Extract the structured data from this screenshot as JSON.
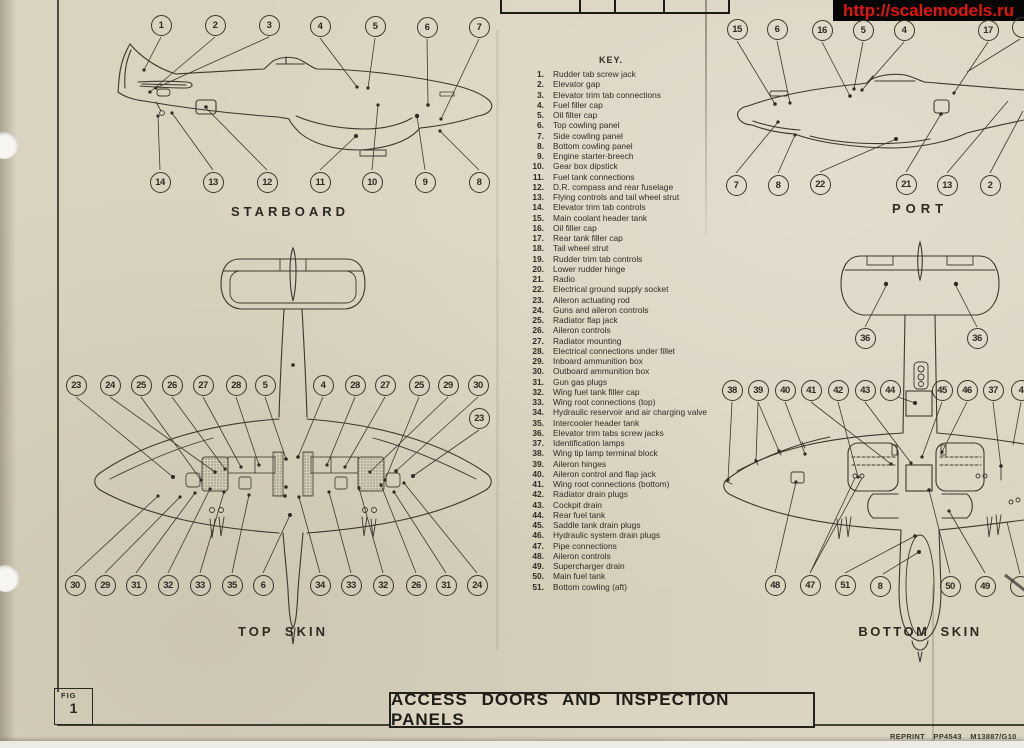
{
  "banner": {
    "url_text": "http://scalemodels.ru",
    "bg_color": "#060606",
    "text_color": "#e41410"
  },
  "header_table": {
    "cells": [
      "",
      "",
      "SECT.",
      "CHAP."
    ]
  },
  "view_labels": {
    "starboard": "STARBOARD",
    "port": "PORT",
    "topskin": "TOP SKIN",
    "bottomskin": "BOTTOM SKIN"
  },
  "key": {
    "title": "KEY.",
    "items": [
      {
        "n": "1.",
        "t": "Rudder tab screw jack"
      },
      {
        "n": "2.",
        "t": "Elevator gap"
      },
      {
        "n": "3.",
        "t": "Elevator trim tab connections"
      },
      {
        "n": "4.",
        "t": "Fuel filler cap"
      },
      {
        "n": "5.",
        "t": "Oil filter cap"
      },
      {
        "n": "6.",
        "t": "Top cowling panel"
      },
      {
        "n": "7.",
        "t": "Side cowling panel"
      },
      {
        "n": "8.",
        "t": "Bottom cowling panel"
      },
      {
        "n": "9.",
        "t": "Engine starter-breech"
      },
      {
        "n": "10.",
        "t": "Gear box dipstick"
      },
      {
        "n": "11.",
        "t": "Fuel tank connections"
      },
      {
        "n": "12.",
        "t": "D.R. compass and rear fuselage"
      },
      {
        "n": "13.",
        "t": "Flying controls and tail wheel strut"
      },
      {
        "n": "14.",
        "t": "Elevator trim tab controls"
      },
      {
        "n": "15.",
        "t": "Main coolant header tank"
      },
      {
        "n": "16.",
        "t": "Oil filler cap"
      },
      {
        "n": "17.",
        "t": "Rear tank filler cap"
      },
      {
        "n": "18.",
        "t": "Tail wheel strut"
      },
      {
        "n": "19.",
        "t": "Rudder trim tab controls"
      },
      {
        "n": "20.",
        "t": "Lower rudder hinge"
      },
      {
        "n": "21.",
        "t": "Radio"
      },
      {
        "n": "22.",
        "t": "Electrical ground supply socket"
      },
      {
        "n": "23.",
        "t": "Aileron actuating rod"
      },
      {
        "n": "24.",
        "t": "Guns and aileron controls"
      },
      {
        "n": "25.",
        "t": "Radiator flap jack"
      },
      {
        "n": "26.",
        "t": "Aileron controls"
      },
      {
        "n": "27.",
        "t": "Radiator mounting"
      },
      {
        "n": "28.",
        "t": "Electrical connections under fillet"
      },
      {
        "n": "29.",
        "t": "Inboard ammunition box"
      },
      {
        "n": "30.",
        "t": "Outboard ammunition box"
      },
      {
        "n": "31.",
        "t": "Gun gas plugs"
      },
      {
        "n": "32.",
        "t": "Wing fuel tank filler cap"
      },
      {
        "n": "33.",
        "t": "Wing root connections (top)"
      },
      {
        "n": "34.",
        "t": "Hydraulic reservoir and air charging valve"
      },
      {
        "n": "35.",
        "t": "Intercooler header tank"
      },
      {
        "n": "36.",
        "t": "Elevator trim tabs screw jacks"
      },
      {
        "n": "37.",
        "t": "Identification lamps"
      },
      {
        "n": "38.",
        "t": "Wing tip lamp terminal block"
      },
      {
        "n": "39.",
        "t": "Aileron hinges"
      },
      {
        "n": "40.",
        "t": "Aileron control and flap jack"
      },
      {
        "n": "41.",
        "t": "Wing root connections (bottom)"
      },
      {
        "n": "42.",
        "t": "Radiator drain plugs"
      },
      {
        "n": "43.",
        "t": "Cockpit drain"
      },
      {
        "n": "44.",
        "t": "Rear fuel tank"
      },
      {
        "n": "45.",
        "t": "Saddle tank drain plugs"
      },
      {
        "n": "46.",
        "t": "Hydraulic system drain plugs"
      },
      {
        "n": "47.",
        "t": "Pipe connections"
      },
      {
        "n": "48.",
        "t": "Aileron controls"
      },
      {
        "n": "49.",
        "t": "Supercharger drain"
      },
      {
        "n": "50.",
        "t": "Main fuel tank"
      },
      {
        "n": "51.",
        "t": "Bottom cowling (aft)"
      }
    ]
  },
  "callouts": [
    {
      "n": "1",
      "x": 161,
      "y": 25
    },
    {
      "n": "2",
      "x": 215,
      "y": 25
    },
    {
      "n": "3",
      "x": 269,
      "y": 25
    },
    {
      "n": "4",
      "x": 320,
      "y": 26
    },
    {
      "n": "5",
      "x": 375,
      "y": 26
    },
    {
      "n": "6",
      "x": 427,
      "y": 27
    },
    {
      "n": "7",
      "x": 479,
      "y": 27
    },
    {
      "n": "14",
      "x": 160,
      "y": 182
    },
    {
      "n": "13",
      "x": 213,
      "y": 182
    },
    {
      "n": "12",
      "x": 267,
      "y": 182
    },
    {
      "n": "11",
      "x": 320,
      "y": 182
    },
    {
      "n": "10",
      "x": 372,
      "y": 182
    },
    {
      "n": "9",
      "x": 425,
      "y": 182
    },
    {
      "n": "8",
      "x": 479,
      "y": 182
    },
    {
      "n": "15",
      "x": 737,
      "y": 29
    },
    {
      "n": "6",
      "x": 777,
      "y": 29
    },
    {
      "n": "16",
      "x": 822,
      "y": 30
    },
    {
      "n": "5",
      "x": 863,
      "y": 30
    },
    {
      "n": "4",
      "x": 904,
      "y": 30
    },
    {
      "n": "17",
      "x": 988,
      "y": 30
    },
    {
      "n": "",
      "x": 1022,
      "y": 27
    },
    {
      "n": "7",
      "x": 736,
      "y": 185
    },
    {
      "n": "8",
      "x": 778,
      "y": 185
    },
    {
      "n": "22",
      "x": 820,
      "y": 184
    },
    {
      "n": "21",
      "x": 906,
      "y": 184
    },
    {
      "n": "13",
      "x": 947,
      "y": 185
    },
    {
      "n": "2",
      "x": 990,
      "y": 185
    },
    {
      "n": "23",
      "x": 76,
      "y": 385
    },
    {
      "n": "24",
      "x": 110,
      "y": 385
    },
    {
      "n": "25",
      "x": 141,
      "y": 385
    },
    {
      "n": "26",
      "x": 172,
      "y": 385
    },
    {
      "n": "27",
      "x": 203,
      "y": 385
    },
    {
      "n": "28",
      "x": 236,
      "y": 385
    },
    {
      "n": "5",
      "x": 265,
      "y": 385
    },
    {
      "n": "4",
      "x": 323,
      "y": 385
    },
    {
      "n": "28",
      "x": 355,
      "y": 385
    },
    {
      "n": "27",
      "x": 385,
      "y": 385
    },
    {
      "n": "25",
      "x": 419,
      "y": 385
    },
    {
      "n": "29",
      "x": 448,
      "y": 385
    },
    {
      "n": "30",
      "x": 478,
      "y": 385
    },
    {
      "n": "23",
      "x": 479,
      "y": 418
    },
    {
      "n": "30",
      "x": 75,
      "y": 585
    },
    {
      "n": "29",
      "x": 105,
      "y": 585
    },
    {
      "n": "31",
      "x": 136,
      "y": 585
    },
    {
      "n": "32",
      "x": 168,
      "y": 585
    },
    {
      "n": "33",
      "x": 200,
      "y": 585
    },
    {
      "n": "35",
      "x": 232,
      "y": 585
    },
    {
      "n": "6",
      "x": 263,
      "y": 585
    },
    {
      "n": "34",
      "x": 320,
      "y": 585
    },
    {
      "n": "33",
      "x": 351,
      "y": 585
    },
    {
      "n": "32",
      "x": 383,
      "y": 585
    },
    {
      "n": "26",
      "x": 416,
      "y": 585
    },
    {
      "n": "31",
      "x": 446,
      "y": 585
    },
    {
      "n": "24",
      "x": 477,
      "y": 585
    },
    {
      "n": "36",
      "x": 865,
      "y": 338
    },
    {
      "n": "36",
      "x": 977,
      "y": 338
    },
    {
      "n": "38",
      "x": 732,
      "y": 390
    },
    {
      "n": "39",
      "x": 758,
      "y": 390
    },
    {
      "n": "40",
      "x": 785,
      "y": 390
    },
    {
      "n": "41",
      "x": 811,
      "y": 390
    },
    {
      "n": "42",
      "x": 838,
      "y": 390
    },
    {
      "n": "43",
      "x": 865,
      "y": 390
    },
    {
      "n": "44",
      "x": 890,
      "y": 390
    },
    {
      "n": "45",
      "x": 942,
      "y": 390
    },
    {
      "n": "46",
      "x": 967,
      "y": 390
    },
    {
      "n": "37",
      "x": 993,
      "y": 390
    },
    {
      "n": "4",
      "x": 1021,
      "y": 390
    },
    {
      "n": "48",
      "x": 775,
      "y": 585
    },
    {
      "n": "47",
      "x": 810,
      "y": 585
    },
    {
      "n": "51",
      "x": 845,
      "y": 585
    },
    {
      "n": "8",
      "x": 880,
      "y": 586
    },
    {
      "n": "50",
      "x": 950,
      "y": 586
    },
    {
      "n": "49",
      "x": 985,
      "y": 586
    },
    {
      "n": "",
      "x": 1020,
      "y": 586
    }
  ],
  "figure": {
    "fig_label": "FIG",
    "fig_number": "1"
  },
  "title_box": {
    "title": "ACCESS DOORS AND INSPECTION PANELS"
  },
  "footer": {
    "reprint": "REPRINT PP4543 M13887/G10"
  }
}
